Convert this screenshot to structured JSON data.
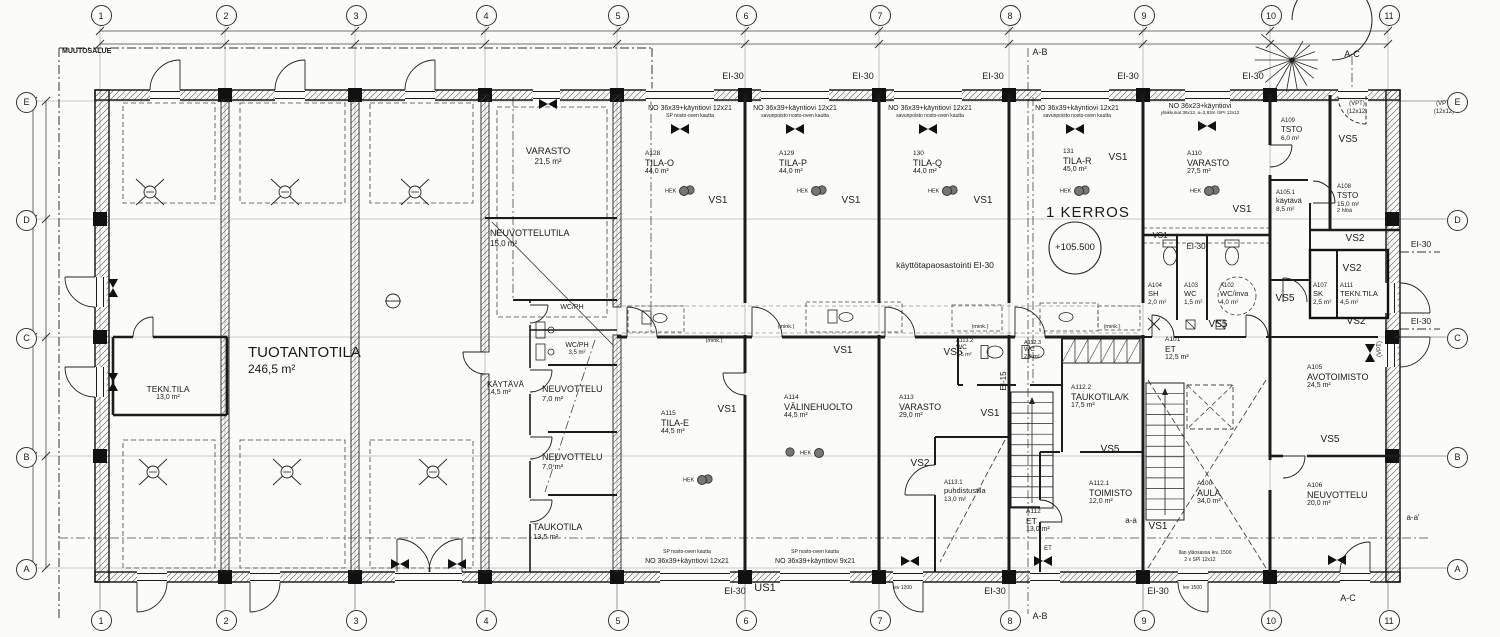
{
  "drawing": {
    "floor_title": "1 KERROS",
    "level_mark": "+105.500",
    "change_area_label": "MUUTOSALUE"
  },
  "grid": {
    "columns": [
      "1",
      "2",
      "3",
      "4",
      "5",
      "6",
      "7",
      "8",
      "9",
      "10",
      "11"
    ],
    "rows": [
      "E",
      "D",
      "C",
      "B",
      "A"
    ]
  },
  "rooms": [
    {
      "code": "",
      "name": "TUOTANTOTILA",
      "area": "246,5 m²"
    },
    {
      "code": "",
      "name": "TEKN.TILA",
      "area": "13,0 m²"
    },
    {
      "code": "",
      "name": "VARASTO",
      "area": "21,5 m²"
    },
    {
      "code": "",
      "name": "NEUVOTTELUTILA",
      "area": "15,0 m²"
    },
    {
      "code": "",
      "name": "WC/PH",
      "area": ""
    },
    {
      "code": "",
      "name": "WC/PH",
      "area": "3,5 m²"
    },
    {
      "code": "",
      "name": "KÄYTÄVÄ",
      "area": "14,5 m²"
    },
    {
      "code": "",
      "name": "NEUVOTTELU",
      "area": "7,0 m²"
    },
    {
      "code": "",
      "name": "NEUVOTTELU",
      "area": "7,0 m²"
    },
    {
      "code": "",
      "name": "TAUKOTILA",
      "area": "13,5 m²"
    },
    {
      "code": "A128",
      "name": "TILA-O",
      "area": "44,0 m²"
    },
    {
      "code": "A129",
      "name": "TILA-P",
      "area": "44,0 m²"
    },
    {
      "code": "130",
      "name": "TILA-Q",
      "area": "44,0 m²"
    },
    {
      "code": "131",
      "name": "TILA-R",
      "area": "45,0 m²"
    },
    {
      "code": "A110",
      "name": "VARASTO",
      "area": "27,5 m²"
    },
    {
      "code": "A109",
      "name": "TSTO",
      "area": "6,0 m²"
    },
    {
      "code": "A108",
      "name": "TSTO",
      "area": "15,0 m²",
      "note": "2 hlöä"
    },
    {
      "code": "A105.1",
      "name": "käytävä",
      "area": "8,5 m²"
    },
    {
      "code": "A104",
      "name": "SH",
      "area": "2,0 m²"
    },
    {
      "code": "A103",
      "name": "WC",
      "area": "1,5 m²"
    },
    {
      "code": "A102",
      "name": "WC/inva",
      "area": "4,0 m²"
    },
    {
      "code": "A107",
      "name": "SK",
      "area": "2,5 m²"
    },
    {
      "code": "A111",
      "name": "TEKN.TILA",
      "area": "4,5 m²"
    },
    {
      "code": "A115",
      "name": "TILA-E",
      "area": "44,5 m²"
    },
    {
      "code": "A114",
      "name": "VÄLINEHUOLTO",
      "area": "44,5 m²"
    },
    {
      "code": "A113",
      "name": "VARASTO",
      "area": "29,0 m²"
    },
    {
      "code": "A113.2",
      "name": "WC",
      "area": "1,5 m²"
    },
    {
      "code": "A112.3",
      "name": "WC",
      "area": "2,0 m²"
    },
    {
      "code": "A113.1",
      "name": "puhdistustila",
      "area": "13,0 m²"
    },
    {
      "code": "A112.2",
      "name": "TAUKOTILA/K",
      "area": "17,5 m²"
    },
    {
      "code": "A112.1",
      "name": "TOIMISTO",
      "area": "12,0 m²"
    },
    {
      "code": "A112",
      "name": "ET",
      "area": "13,0 m²"
    },
    {
      "code": "A101",
      "name": "ET",
      "area": "12,5 m²"
    },
    {
      "code": "A100",
      "name": "AULA",
      "area": "34,0 m²"
    },
    {
      "code": "A105",
      "name": "AVOTOIMISTO",
      "area": "24,5 m²"
    },
    {
      "code": "A106",
      "name": "NEUVOTTELU",
      "area": "20,0 m²"
    }
  ],
  "annotations": [
    {
      "t": "EI-30"
    },
    {
      "t": "EI-30"
    },
    {
      "t": "EI-30"
    },
    {
      "t": "EI-30"
    },
    {
      "t": "EI-30"
    },
    {
      "t": "A-B"
    },
    {
      "t": "A-C"
    },
    {
      "t": "NO 36x39+käyntiovi 12x21"
    },
    {
      "t": "SP nosto-oven kautta"
    },
    {
      "t": "NO 36x39+käyntiovi 12x21"
    },
    {
      "t": "savunpoisto nosto-oven kautta"
    },
    {
      "t": "NO 36x39+käyntiovi 12x21"
    },
    {
      "t": "savunpoisto nosto-oven kautta"
    },
    {
      "t": "NO 36x39+käyntiovi 12x21"
    },
    {
      "t": "savunpoisto nosto-oven kautta"
    },
    {
      "t": "NO 36x23+käyntiovi"
    },
    {
      "t": "yläikkunat 36x12, a=3,93m /SPI 12x12"
    },
    {
      "t": "(VPT)"
    },
    {
      "t": "(12x12)"
    },
    {
      "t": "(VPT)"
    },
    {
      "t": "(12x12)"
    },
    {
      "t": "VS1"
    },
    {
      "t": "VS1"
    },
    {
      "t": "VS1"
    },
    {
      "t": "VS1"
    },
    {
      "t": "VS1"
    },
    {
      "t": "VS5"
    },
    {
      "t": "käyttötapaosastointi EI-30"
    },
    {
      "t": "VS1"
    },
    {
      "t": "EI-30"
    },
    {
      "t": "VS2"
    },
    {
      "t": "EI-30"
    },
    {
      "t": "VS2"
    },
    {
      "t": "EI-15"
    },
    {
      "t": "VS5"
    },
    {
      "t": "VS5"
    },
    {
      "t": "VS2"
    },
    {
      "t": "EI-30"
    },
    {
      "t": "(mink.)"
    },
    {
      "t": "(mink.)"
    },
    {
      "t": "(mink.)"
    },
    {
      "t": "(mink.)"
    },
    {
      "t": "VS1"
    },
    {
      "t": "VS1"
    },
    {
      "t": "VS5"
    },
    {
      "t": "VS1"
    },
    {
      "t": "VS2"
    },
    {
      "t": "VS5"
    },
    {
      "t": "VS1"
    },
    {
      "t": "VS5"
    },
    {
      "t": "a-a"
    },
    {
      "t": "a-a'"
    },
    {
      "t": "HEK"
    },
    {
      "t": "HEK"
    },
    {
      "t": "HEK"
    },
    {
      "t": "HEK"
    },
    {
      "t": "HEK"
    },
    {
      "t": "HEK"
    },
    {
      "t": "HEK"
    },
    {
      "t": "EI-30"
    },
    {
      "t": "US1"
    },
    {
      "t": "EI-30"
    },
    {
      "t": "EI-30"
    },
    {
      "t": "A-B"
    },
    {
      "t": "A-C"
    },
    {
      "t": "NO 36x39+käyntiovi 12x21"
    },
    {
      "t": "SP nosto-oven kautta"
    },
    {
      "t": "NO 36x39+käyntiovi 9x21"
    },
    {
      "t": "SP nosto-oven kautta"
    },
    {
      "t": "lev 1200"
    },
    {
      "t": "lev 1500"
    },
    {
      "t": "Ilan yläosassa lev. 1500"
    },
    {
      "t": "2 x SPI 12x12"
    },
    {
      "t": "ET"
    },
    {
      "t": "(VPT)"
    }
  ]
}
